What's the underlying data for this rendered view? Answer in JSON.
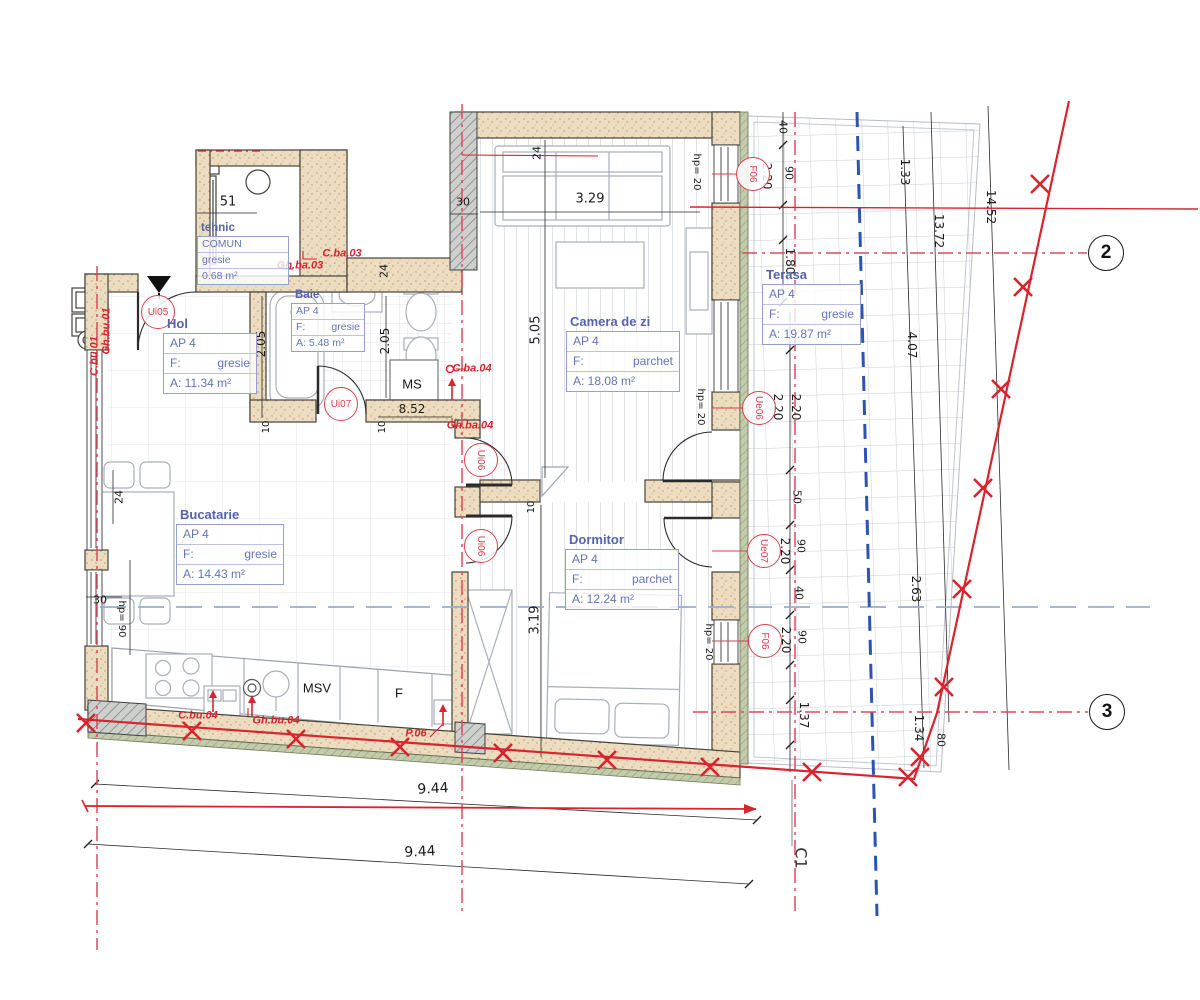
{
  "plan": {
    "colors": {
      "wall_fill": "#ecdcc0",
      "wall_line": "#45423b",
      "hatch_gray": "#cdd0cc",
      "survey_red": "#d9232e",
      "centerline_magenta": "#e0485e",
      "boundary_blue": "#2d54b4",
      "setback_bluegray": "#9aaccb",
      "room_text": "#6474b8",
      "room_title": "#5563ac",
      "tag_red": "#d9404e",
      "dim_text": "#1c1c1c",
      "insulation_olive": "#c2cbab"
    },
    "rooms": [
      {
        "title": "tehnic",
        "x": 197,
        "y": 222,
        "w": 90,
        "small": true,
        "rows": [
          {
            "l": "COMUN"
          },
          {
            "l": "gresie"
          },
          {
            "l": "0.68 m²"
          }
        ]
      },
      {
        "title": "Hol",
        "x": 163,
        "y": 316,
        "w": 92,
        "rows": [
          {
            "l": "AP 4"
          },
          {
            "l": "F:",
            "v": "gresie"
          },
          {
            "l": "A: 11.34 m²"
          }
        ]
      },
      {
        "title": "Baie",
        "x": 291,
        "y": 289,
        "w": 72,
        "small": true,
        "rows": [
          {
            "l": "AP 4"
          },
          {
            "l": "F:",
            "v": "gresie"
          },
          {
            "l": "A: 5.48 m²"
          }
        ]
      },
      {
        "title": "Camera de zi",
        "x": 566,
        "y": 314,
        "w": 112,
        "rows": [
          {
            "l": "AP 4"
          },
          {
            "l": "F:",
            "v": "parchet"
          },
          {
            "l": "A: 18.08 m²"
          }
        ]
      },
      {
        "title": "Terasa",
        "x": 762,
        "y": 267,
        "w": 97,
        "rows": [
          {
            "l": "AP 4"
          },
          {
            "l": "F:",
            "v": "gresie"
          },
          {
            "l": "A: 19.87 m²"
          }
        ]
      },
      {
        "title": "Bucatarie",
        "x": 176,
        "y": 507,
        "w": 106,
        "rows": [
          {
            "l": "AP 4"
          },
          {
            "l": "F:",
            "v": "gresie"
          },
          {
            "l": "A: 14.43 m²"
          }
        ]
      },
      {
        "title": "Dormitor",
        "x": 565,
        "y": 532,
        "w": 112,
        "rows": [
          {
            "l": "AP 4"
          },
          {
            "l": "F:",
            "v": "parchet"
          },
          {
            "l": "A: 12.24 m²"
          }
        ]
      }
    ],
    "dimensions": [
      {
        "t": "51",
        "x": 228,
        "y": 202,
        "r": 0,
        "s": 13
      },
      {
        "t": "3.29",
        "x": 590,
        "y": 199,
        "r": 0,
        "s": 13
      },
      {
        "t": "24",
        "x": 537,
        "y": 153,
        "r": -90,
        "s": 11
      },
      {
        "t": "30",
        "x": 463,
        "y": 202,
        "r": 0,
        "s": 11
      },
      {
        "t": "24",
        "x": 384,
        "y": 271,
        "r": -90,
        "s": 11
      },
      {
        "t": "2.05",
        "x": 261,
        "y": 344,
        "r": -90,
        "s": 12
      },
      {
        "t": "2.05",
        "x": 385,
        "y": 341,
        "r": -90,
        "s": 12
      },
      {
        "t": "5.05",
        "x": 536,
        "y": 330,
        "r": -90,
        "s": 13
      },
      {
        "t": "8.52",
        "x": 412,
        "y": 409,
        "r": 0,
        "s": 12
      },
      {
        "t": "10",
        "x": 267,
        "y": 427,
        "r": -90,
        "s": 10
      },
      {
        "t": "10",
        "x": 383,
        "y": 427,
        "r": -90,
        "s": 10
      },
      {
        "t": "10",
        "x": 532,
        "y": 507,
        "r": -90,
        "s": 10
      },
      {
        "t": "3.19",
        "x": 535,
        "y": 620,
        "r": -90,
        "s": 13
      },
      {
        "t": "24",
        "x": 119,
        "y": 497,
        "r": -90,
        "s": 11
      },
      {
        "t": "30",
        "x": 100,
        "y": 600,
        "r": 0,
        "s": 11
      },
      {
        "t": "hp= 90",
        "x": 121,
        "y": 619,
        "r": 90,
        "s": 10
      },
      {
        "t": "hp= 20",
        "x": 696,
        "y": 172,
        "r": 90,
        "s": 10
      },
      {
        "t": "40",
        "x": 783,
        "y": 127,
        "r": 90,
        "s": 11
      },
      {
        "t": "2.20",
        "x": 767,
        "y": 176,
        "r": 90,
        "s": 12
      },
      {
        "t": "90",
        "x": 789,
        "y": 173,
        "r": 90,
        "s": 11
      },
      {
        "t": "1.80",
        "x": 790,
        "y": 261,
        "r": 90,
        "s": 12
      },
      {
        "t": "2.20",
        "x": 778,
        "y": 407,
        "r": 90,
        "s": 12
      },
      {
        "t": "2.20",
        "x": 796,
        "y": 407,
        "r": 90,
        "s": 12
      },
      {
        "t": "hp= 20",
        "x": 700,
        "y": 407,
        "r": 90,
        "s": 10
      },
      {
        "t": "50",
        "x": 797,
        "y": 497,
        "r": 90,
        "s": 11
      },
      {
        "t": "2.20",
        "x": 785,
        "y": 551,
        "r": 90,
        "s": 12
      },
      {
        "t": "90",
        "x": 801,
        "y": 546,
        "r": 90,
        "s": 11
      },
      {
        "t": "40",
        "x": 799,
        "y": 593,
        "r": 90,
        "s": 11
      },
      {
        "t": "2.20",
        "x": 786,
        "y": 640,
        "r": 90,
        "s": 12
      },
      {
        "t": "90",
        "x": 802,
        "y": 637,
        "r": 90,
        "s": 11
      },
      {
        "t": "hp= 20",
        "x": 708,
        "y": 642,
        "r": 90,
        "s": 10
      },
      {
        "t": "1.37",
        "x": 804,
        "y": 715,
        "r": 90,
        "s": 12
      },
      {
        "t": "1.34",
        "x": 919,
        "y": 728,
        "r": 90,
        "s": 12
      },
      {
        "t": "80",
        "x": 941,
        "y": 740,
        "r": 90,
        "s": 11
      },
      {
        "t": "2.63",
        "x": 916,
        "y": 589,
        "r": 90,
        "s": 12
      },
      {
        "t": "4.07",
        "x": 912,
        "y": 345,
        "r": 90,
        "s": 12
      },
      {
        "t": "1.33",
        "x": 905,
        "y": 172,
        "r": 90,
        "s": 12
      },
      {
        "t": "13.72",
        "x": 939,
        "y": 231,
        "r": 90,
        "s": 12
      },
      {
        "t": "14.52",
        "x": 991,
        "y": 207,
        "r": 90,
        "s": 12
      },
      {
        "t": "9.44",
        "x": 433,
        "y": 789,
        "r": -3,
        "s": 14
      },
      {
        "t": "9.44",
        "x": 420,
        "y": 852,
        "r": -3,
        "s": 14
      }
    ],
    "tags": [
      {
        "t": "Ui05",
        "x": 158,
        "y": 312,
        "r": 0
      },
      {
        "t": "Ui07",
        "x": 341,
        "y": 404,
        "r": 0
      },
      {
        "t": "Ui06",
        "x": 481,
        "y": 460,
        "r": 90
      },
      {
        "t": "Ui06",
        "x": 481,
        "y": 546,
        "r": 90
      },
      {
        "t": "Ue06",
        "x": 759,
        "y": 408,
        "r": 90
      },
      {
        "t": "Ue07",
        "x": 764,
        "y": 551,
        "r": 90
      },
      {
        "t": "F06",
        "x": 753,
        "y": 174,
        "r": 90
      },
      {
        "t": "F06",
        "x": 765,
        "y": 641,
        "r": 90
      }
    ],
    "plumbing": [
      {
        "t": "C.ba.03",
        "x": 342,
        "y": 254,
        "r": 0
      },
      {
        "t": "Gh.ba.03",
        "x": 300,
        "y": 266,
        "r": 0
      },
      {
        "t": "C.ba.04",
        "x": 472,
        "y": 369,
        "r": 0
      },
      {
        "t": "Gh.ba.04",
        "x": 470,
        "y": 426,
        "r": 0
      },
      {
        "t": "C.bu.04",
        "x": 198,
        "y": 716,
        "r": 0
      },
      {
        "t": "Gh.bu.04",
        "x": 276,
        "y": 721,
        "r": 0
      },
      {
        "t": "P.06",
        "x": 416,
        "y": 734,
        "r": 0
      },
      {
        "t": "Gh.bu.01",
        "x": 107,
        "y": 331,
        "r": -90
      },
      {
        "t": "C.bu.01",
        "x": 95,
        "y": 356,
        "r": -90
      }
    ],
    "appliances": [
      {
        "t": "MS",
        "x": 412,
        "y": 384
      },
      {
        "t": "MSV",
        "x": 317,
        "y": 688
      },
      {
        "t": "F",
        "x": 399,
        "y": 693
      }
    ],
    "bubbles": [
      {
        "t": "2",
        "x": 1106,
        "y": 253
      },
      {
        "t": "3",
        "x": 1107,
        "y": 712
      }
    ],
    "axis_mark": {
      "t": "C1",
      "x": 801,
      "y": 858,
      "r": 90
    }
  }
}
